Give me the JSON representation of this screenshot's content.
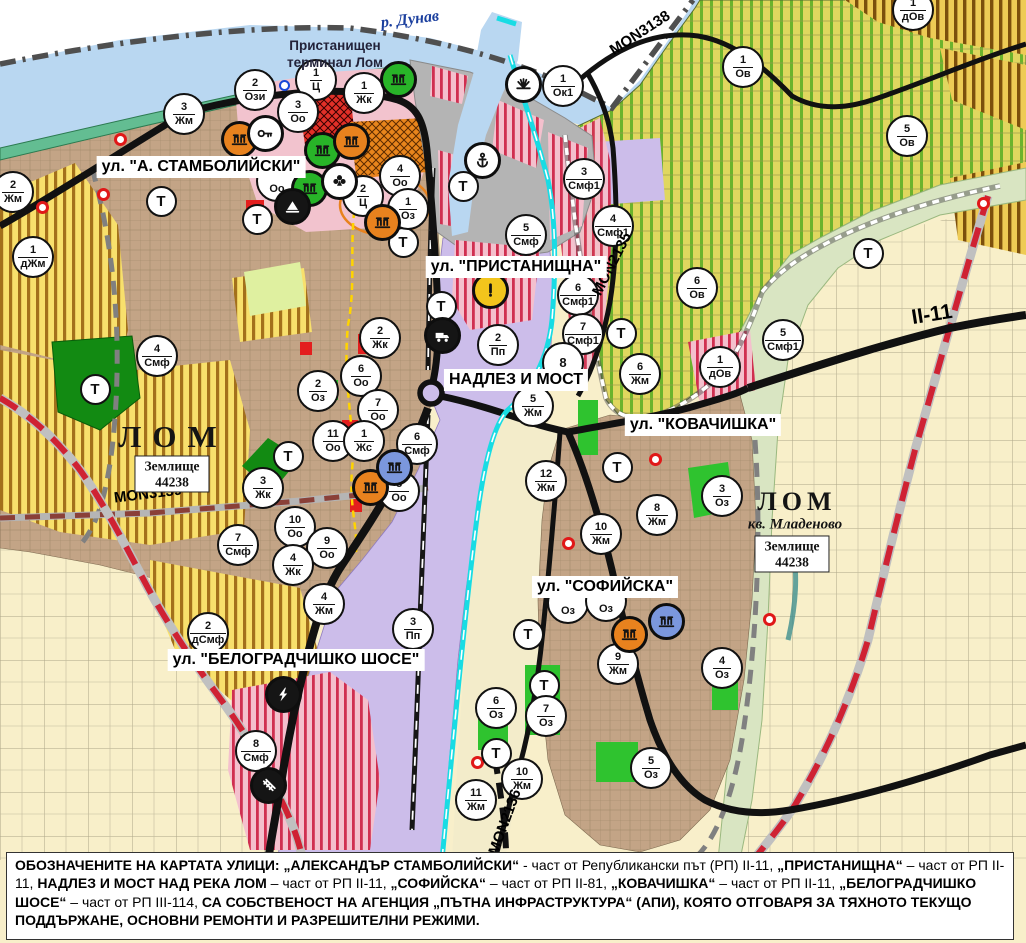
{
  "map": {
    "region_labels": {
      "river": "р. Дунав",
      "port_terminal_line1": "Пристанищен",
      "port_terminal_line2": "терминал Лом",
      "city_west": "ЛОМ",
      "city_east": "ЛОМ",
      "district_east": "кв. Младеново",
      "land_unit": {
        "line1": "Землище",
        "line2": "44238"
      }
    },
    "street_labels": [
      {
        "text": "ул. \"А. СТАМБОЛИЙСКИ\"",
        "x": 201,
        "y": 167
      },
      {
        "text": "ул. \"ПРИСТАНИЩНА\"",
        "x": 516,
        "y": 267
      },
      {
        "text": "НАДЛЕЗ И МОСТ",
        "x": 516,
        "y": 380
      },
      {
        "text": "ул. \"КОВАЧИШКА\"",
        "x": 703,
        "y": 425
      },
      {
        "text": "ул. \"СОФИЙСКА\"",
        "x": 605,
        "y": 587
      },
      {
        "text": "ул. \"БЕЛОГРАДЧИШКО ШОСЕ\"",
        "x": 296,
        "y": 660
      }
    ],
    "road_labels": [
      {
        "text": "MON3138",
        "x": 640,
        "y": 33,
        "rot": -33,
        "big": false
      },
      {
        "text": "MON2135",
        "x": 612,
        "y": 264,
        "rot": -63,
        "big": false
      },
      {
        "text": "MON3139",
        "x": 148,
        "y": 494,
        "rot": -7,
        "big": false
      },
      {
        "text": "MON2136",
        "x": 505,
        "y": 822,
        "rot": -70,
        "big": false
      },
      {
        "text": "II-11",
        "x": 932,
        "y": 315,
        "rot": -9,
        "big": true
      }
    ],
    "t_label": "Т",
    "t_markers": [
      {
        "x": 95,
        "y": 389
      },
      {
        "x": 161,
        "y": 201
      },
      {
        "x": 257,
        "y": 219
      },
      {
        "x": 403,
        "y": 242
      },
      {
        "x": 441,
        "y": 306
      },
      {
        "x": 463,
        "y": 186
      },
      {
        "x": 621,
        "y": 333
      },
      {
        "x": 617,
        "y": 467
      },
      {
        "x": 528,
        "y": 634
      },
      {
        "x": 544,
        "y": 685
      },
      {
        "x": 496,
        "y": 753
      },
      {
        "x": 288,
        "y": 456
      },
      {
        "x": 868,
        "y": 253
      }
    ],
    "markers": [
      {
        "x": 255,
        "y": 90,
        "num": "2",
        "code": "Ози"
      },
      {
        "x": 316,
        "y": 80,
        "num": "1",
        "code": "Ц"
      },
      {
        "x": 298,
        "y": 112,
        "num": "3",
        "code": "Оо"
      },
      {
        "x": 364,
        "y": 93,
        "num": "1",
        "code": "Жк"
      },
      {
        "x": 563,
        "y": 86,
        "num": "1",
        "code": "Ок1"
      },
      {
        "x": 184,
        "y": 114,
        "num": "3",
        "code": "Жм"
      },
      {
        "x": 13,
        "y": 192,
        "num": "2",
        "code": "Жм"
      },
      {
        "x": 33,
        "y": 257,
        "num": "1",
        "code": "дЖм"
      },
      {
        "x": 400,
        "y": 176,
        "num": "4",
        "code": "Оо"
      },
      {
        "x": 363,
        "y": 196,
        "num": "2",
        "code": "Ц"
      },
      {
        "x": 408,
        "y": 209,
        "num": "1",
        "code": "Оз"
      },
      {
        "x": 157,
        "y": 356,
        "num": "4",
        "code": "Смф"
      },
      {
        "x": 318,
        "y": 391,
        "num": "2",
        "code": "Оз"
      },
      {
        "x": 526,
        "y": 235,
        "num": "5",
        "code": "Смф"
      },
      {
        "x": 584,
        "y": 179,
        "num": "3",
        "code": "Смф1"
      },
      {
        "x": 613,
        "y": 226,
        "num": "4",
        "code": "Смф1"
      },
      {
        "x": 578,
        "y": 295,
        "num": "6",
        "code": "Смф1"
      },
      {
        "x": 583,
        "y": 334,
        "num": "7",
        "code": "Смф1"
      },
      {
        "x": 697,
        "y": 288,
        "num": "6",
        "code": "Ов"
      },
      {
        "x": 743,
        "y": 67,
        "num": "1",
        "code": "Ов"
      },
      {
        "x": 913,
        "y": 10,
        "num": "1",
        "code": "дОв"
      },
      {
        "x": 907,
        "y": 136,
        "num": "5",
        "code": "Ов"
      },
      {
        "x": 783,
        "y": 340,
        "num": "5",
        "code": "Смф1"
      },
      {
        "x": 720,
        "y": 367,
        "num": "1",
        "code": "дОв"
      },
      {
        "x": 380,
        "y": 338,
        "num": "2",
        "code": "Жк"
      },
      {
        "x": 361,
        "y": 376,
        "num": "6",
        "code": "Оо"
      },
      {
        "x": 378,
        "y": 410,
        "num": "7",
        "code": "Оо"
      },
      {
        "x": 498,
        "y": 345,
        "num": "2",
        "code": "Пп"
      },
      {
        "x": 563,
        "y": 363,
        "num": "8",
        "code": ""
      },
      {
        "x": 533,
        "y": 406,
        "num": "5",
        "code": "Жм"
      },
      {
        "x": 640,
        "y": 374,
        "num": "6",
        "code": "Жм"
      },
      {
        "x": 546,
        "y": 481,
        "num": "12",
        "code": "Жм"
      },
      {
        "x": 601,
        "y": 534,
        "num": "10",
        "code": "Жм"
      },
      {
        "x": 657,
        "y": 515,
        "num": "8",
        "code": "Жм"
      },
      {
        "x": 722,
        "y": 496,
        "num": "3",
        "code": "Оз"
      },
      {
        "x": 333,
        "y": 441,
        "num": "11",
        "code": "Оо"
      },
      {
        "x": 364,
        "y": 441,
        "num": "1",
        "code": "Жс"
      },
      {
        "x": 417,
        "y": 444,
        "num": "6",
        "code": "Смф"
      },
      {
        "x": 399,
        "y": 491,
        "num": "8",
        "code": "Оо"
      },
      {
        "x": 295,
        "y": 527,
        "num": "10",
        "code": "Оо"
      },
      {
        "x": 327,
        "y": 548,
        "num": "9",
        "code": "Оо"
      },
      {
        "x": 238,
        "y": 545,
        "num": "7",
        "code": "Смф"
      },
      {
        "x": 293,
        "y": 565,
        "num": "4",
        "code": "Жк"
      },
      {
        "x": 263,
        "y": 488,
        "num": "3",
        "code": "Жк"
      },
      {
        "x": 208,
        "y": 633,
        "num": "2",
        "code": "дСмф"
      },
      {
        "x": 324,
        "y": 604,
        "num": "4",
        "code": "Жм"
      },
      {
        "x": 413,
        "y": 629,
        "num": "3",
        "code": "Пп"
      },
      {
        "x": 256,
        "y": 751,
        "num": "8",
        "code": "Смф"
      },
      {
        "x": 618,
        "y": 664,
        "num": "9",
        "code": "Жм"
      },
      {
        "x": 722,
        "y": 668,
        "num": "4",
        "code": "Оз"
      },
      {
        "x": 496,
        "y": 708,
        "num": "6",
        "code": "Оз"
      },
      {
        "x": 546,
        "y": 716,
        "num": "7",
        "code": "Оз"
      },
      {
        "x": 651,
        "y": 768,
        "num": "5",
        "code": "Оз"
      },
      {
        "x": 522,
        "y": 779,
        "num": "10",
        "code": "Жм"
      },
      {
        "x": 476,
        "y": 800,
        "num": "11",
        "code": "Жм"
      },
      {
        "x": 568,
        "y": 603,
        "num": "",
        "code": "Оз"
      },
      {
        "x": 606,
        "y": 601,
        "num": "",
        "code": "Оз"
      },
      {
        "x": 277,
        "y": 181,
        "num": "",
        "code": "Оо"
      }
    ],
    "poi_icons": [
      {
        "x": 398,
        "y": 79,
        "color": "green",
        "icon": "monument"
      },
      {
        "x": 523,
        "y": 84,
        "color": "white",
        "icon": "rays"
      },
      {
        "x": 482,
        "y": 160,
        "color": "white",
        "icon": "anchor"
      },
      {
        "x": 239,
        "y": 139,
        "color": "orange",
        "icon": "monument"
      },
      {
        "x": 265,
        "y": 133,
        "color": "white",
        "icon": "key"
      },
      {
        "x": 322,
        "y": 150,
        "color": "green",
        "icon": "monument"
      },
      {
        "x": 351,
        "y": 141,
        "color": "orange",
        "icon": "monument"
      },
      {
        "x": 309,
        "y": 188,
        "color": "green",
        "icon": "monument"
      },
      {
        "x": 339,
        "y": 181,
        "color": "white",
        "icon": "clover"
      },
      {
        "x": 292,
        "y": 206,
        "color": "black",
        "icon": "peak"
      },
      {
        "x": 382,
        "y": 222,
        "color": "orange",
        "icon": "monument"
      },
      {
        "x": 370,
        "y": 487,
        "color": "orange",
        "icon": "monument"
      },
      {
        "x": 394,
        "y": 467,
        "color": "blue",
        "icon": "monument"
      },
      {
        "x": 490,
        "y": 290,
        "color": "yellow",
        "icon": "exclam"
      },
      {
        "x": 442,
        "y": 335,
        "color": "black",
        "icon": "truck"
      },
      {
        "x": 283,
        "y": 694,
        "color": "black",
        "icon": "lightning"
      },
      {
        "x": 268,
        "y": 785,
        "color": "black",
        "icon": "railway"
      },
      {
        "x": 629,
        "y": 634,
        "color": "orange",
        "icon": "monument"
      },
      {
        "x": 666,
        "y": 621,
        "color": "blue",
        "icon": "monument"
      }
    ],
    "poi_dots": [
      {
        "x": 120,
        "y": 139,
        "color": "red"
      },
      {
        "x": 103,
        "y": 194,
        "color": "red"
      },
      {
        "x": 42,
        "y": 207,
        "color": "red"
      },
      {
        "x": 655,
        "y": 459,
        "color": "red"
      },
      {
        "x": 477,
        "y": 762,
        "color": "red"
      },
      {
        "x": 769,
        "y": 619,
        "color": "red"
      },
      {
        "x": 983,
        "y": 203,
        "color": "red"
      },
      {
        "x": 568,
        "y": 543,
        "color": "red"
      },
      {
        "x": 284,
        "y": 85,
        "color": "blue"
      }
    ]
  },
  "notice": {
    "segments": [
      {
        "text": "ОБОЗНАЧЕНИТЕ НА КАРТАТА УЛИЦИ: „АЛЕКСАНДЪР СТАМБОЛИЙСКИ“",
        "bold": true
      },
      {
        "text": " - част от Републикански път (РП) II-11, ",
        "bold": false
      },
      {
        "text": "„ПРИСТАНИЩНА“",
        "bold": true
      },
      {
        "text": " – част от РП II-11, ",
        "bold": false
      },
      {
        "text": "НАДЛЕЗ И МОСТ НАД РЕКА ЛОМ",
        "bold": true
      },
      {
        "text": " – част от РП II-11, ",
        "bold": false
      },
      {
        "text": "„СОФИЙСКА“",
        "bold": true
      },
      {
        "text": " – част от РП II-81, ",
        "bold": false
      },
      {
        "text": "„КОВАЧИШКА“",
        "bold": true
      },
      {
        "text": " – част от РП II-11, ",
        "bold": false
      },
      {
        "text": "„БЕЛОГРАДЧИШКО ШОСЕ“",
        "bold": true
      },
      {
        "text": " – част от РП III-114, ",
        "bold": false
      },
      {
        "text": "СА СОБСТВЕНОСТ НА АГЕНЦИЯ „ПЪТНА ИНФРАСТРУКТУРА“ (АПИ), КОЯТО ОТГОВАРЯ ЗА ТЯХНОТО ТЕКУЩО ПОДДЪРЖАНЕ, ОСНОВНИ РЕМОНТИ И РАЗРЕШИТЕЛНИ РЕЖИМИ.",
        "bold": true
      }
    ]
  },
  "colors": {
    "poi_orange": "#e8821e",
    "poi_green": "#28b428",
    "poi_blue": "#7b97dd",
    "poi_white": "#ffffff",
    "poi_black": "#151515",
    "poi_yellow": "#f2c51c",
    "water": "#b9d7f1",
    "channel_cyan": "#18dce4",
    "rail_red": "#cf2233",
    "zone_purple": "#ccbdea",
    "zone_urban": "#c3a486",
    "zone_cream": "#f8efca"
  }
}
